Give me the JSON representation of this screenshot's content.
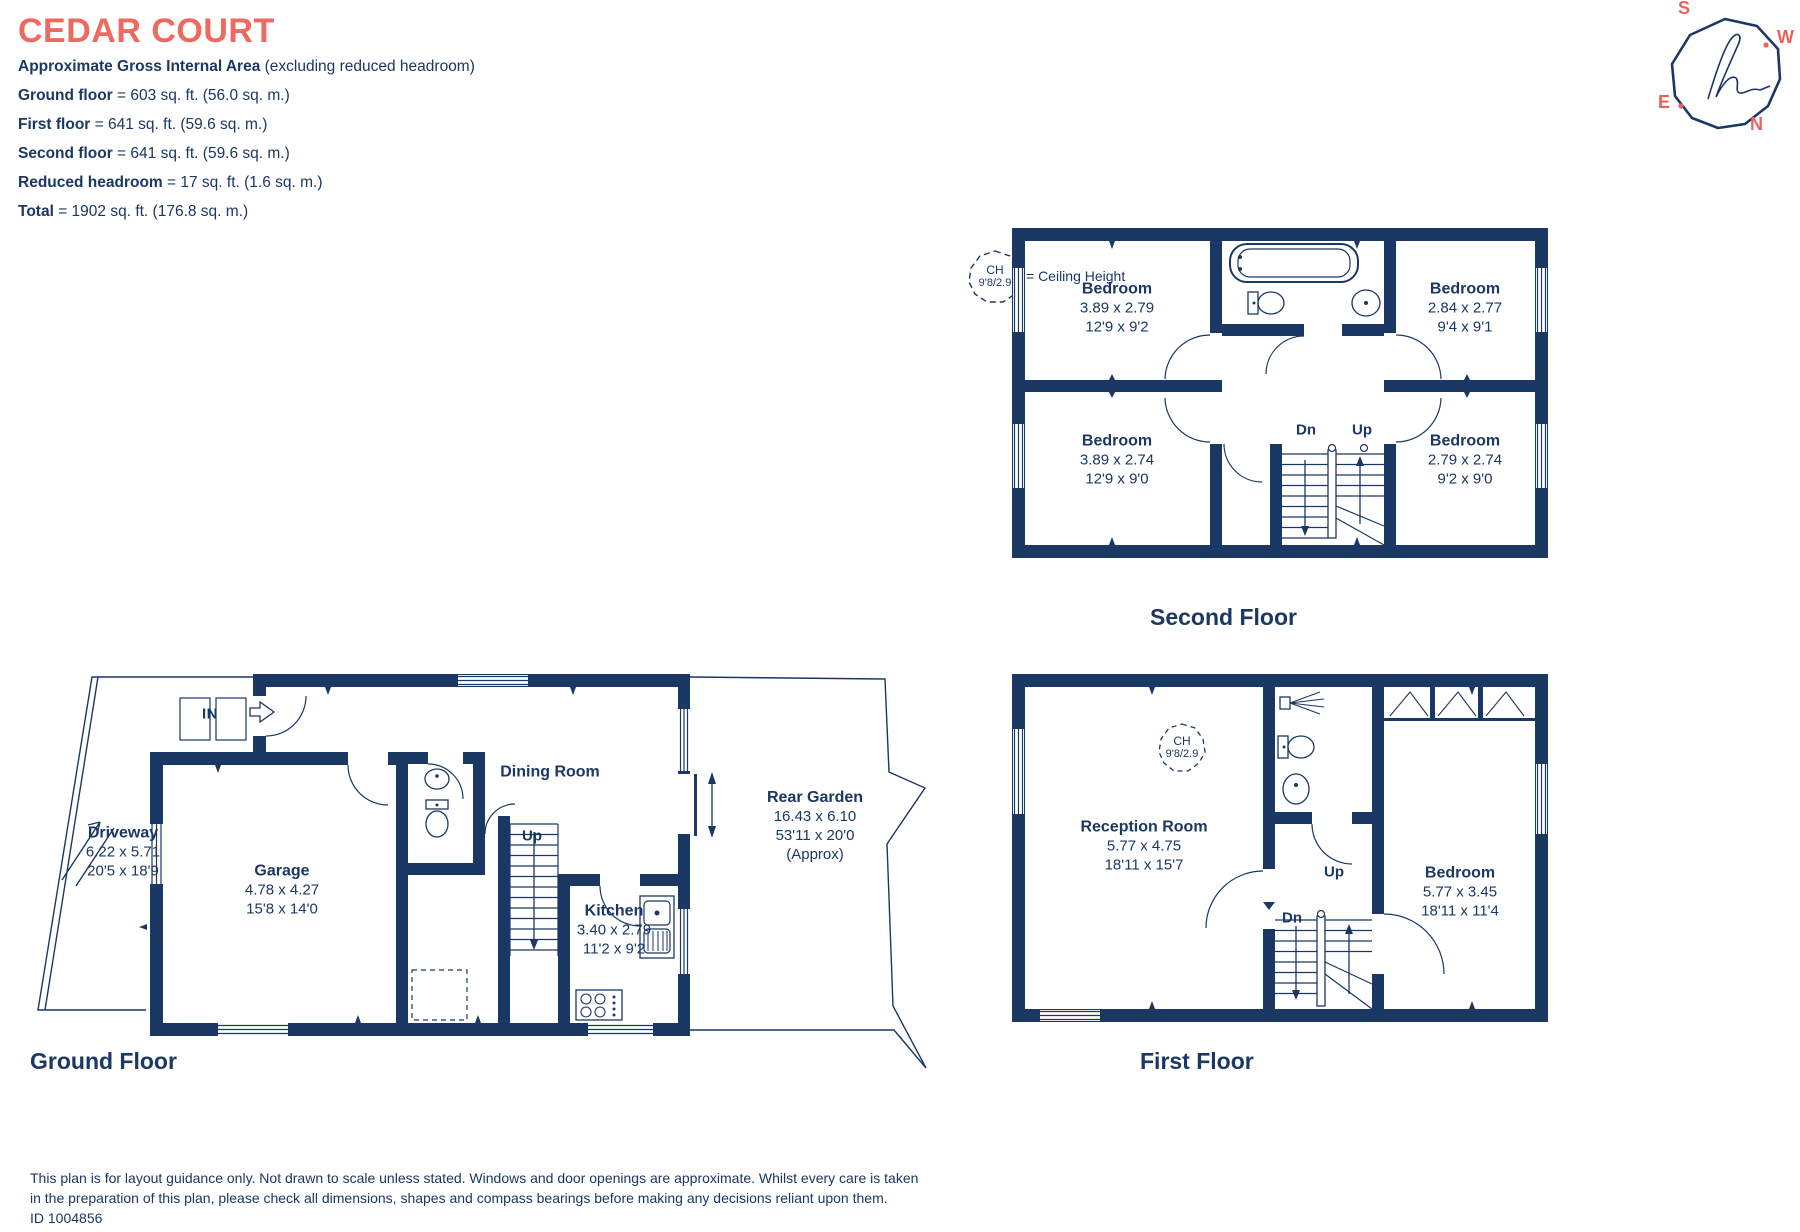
{
  "header": {
    "title": "CEDAR COURT",
    "area_heading": "Approximate Gross Internal Area",
    "area_heading_note": " (excluding reduced headroom)",
    "area_lines": [
      {
        "label": "Ground floor",
        "value": "= 603 sq. ft. (56.0 sq. m.)"
      },
      {
        "label": "First floor",
        "value": "= 641 sq. ft. (59.6 sq. m.)"
      },
      {
        "label": "Second floor",
        "value": "= 641 sq. ft. (59.6 sq. m.)"
      },
      {
        "label": "Reduced headroom",
        "value": "= 17 sq. ft. (1.6 sq. m.)"
      },
      {
        "label": "Total",
        "value": "=  1902 sq. ft. (176.8 sq. m.)"
      }
    ]
  },
  "compass": {
    "n": "N",
    "s": "S",
    "e": "E",
    "w": "W"
  },
  "legend": {
    "ch": "CH",
    "ch_value": "9'8/2.9",
    "text": "= Ceiling Height"
  },
  "stairs": {
    "up": "Up",
    "dn": "Dn"
  },
  "floors": {
    "second": {
      "label": "Second Floor",
      "rooms": {
        "tl": {
          "name": "Bedroom",
          "m": "3.89 x 2.79",
          "ft": "12'9 x 9'2"
        },
        "tr": {
          "name": "Bedroom",
          "m": "2.84 x 2.77",
          "ft": "9'4 x 9'1"
        },
        "bl": {
          "name": "Bedroom",
          "m": "3.89 x 2.74",
          "ft": "12'9 x 9'0"
        },
        "br": {
          "name": "Bedroom",
          "m": "2.79 x 2.74",
          "ft": "9'2 x 9'0"
        }
      }
    },
    "first": {
      "label": "First Floor",
      "rooms": {
        "reception": {
          "name": "Reception Room",
          "m": "5.77 x 4.75",
          "ft": "18'11 x 15'7"
        },
        "bedroom": {
          "name": "Bedroom",
          "m": "5.77 x 3.45",
          "ft": "18'11 x 11'4"
        }
      }
    },
    "ground": {
      "label": "Ground Floor",
      "in_label": "IN",
      "rooms": {
        "driveway": {
          "name": "Driveway",
          "m": "6.22 x 5.71",
          "ft": "20'5 x 18'9"
        },
        "garage": {
          "name": "Garage",
          "m": "4.78 x 4.27",
          "ft": "15'8 x 14'0"
        },
        "dining": {
          "name": "Dining Room"
        },
        "kitchen": {
          "name": "Kitchen",
          "m": "3.40 x 2.79",
          "ft": "11'2 x 9'2"
        },
        "garden": {
          "name": "Rear Garden",
          "m": "16.43 x 6.10",
          "ft": "53'11 x 20'0",
          "note": "(Approx)"
        }
      }
    }
  },
  "footer": {
    "line1": "This plan is for layout guidance only. Not drawn to scale unless stated. Windows and door openings are approximate. Whilst every care is taken",
    "line2": "in the preparation of this plan, please check all dimensions, shapes and compass bearings before making any decisions reliant upon them.",
    "id": "ID 1004856"
  },
  "colors": {
    "accent": "#ee6a60",
    "ink": "#1b3764"
  }
}
